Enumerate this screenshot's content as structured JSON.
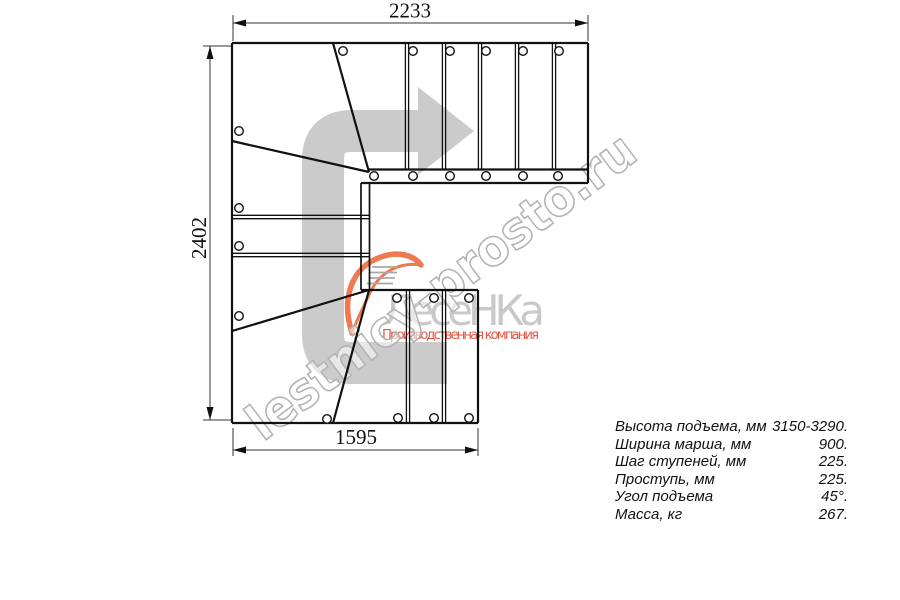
{
  "drawing": {
    "dimensions": {
      "top": "2233",
      "left": "2402",
      "bottom": "1595"
    },
    "watermark": {
      "text": "lestnicy-prosto.ru"
    },
    "brand": {
      "name": "ЛесеНКа",
      "tagline": "Производственная компания"
    },
    "colors": {
      "line": "#111111",
      "direction_arrow": "#cbcbcb",
      "watermark_stroke": "#b3b3b3",
      "brand_gray": "#c9c9c9",
      "brand_red": "#e25a47",
      "logo_orange": "#ef7a50"
    }
  },
  "specs": {
    "rows": [
      {
        "label": "Высота подъема, мм",
        "value": "3150-3290."
      },
      {
        "label": "Ширина марша, мм",
        "value": "900."
      },
      {
        "label": "Шаг ступеней, мм",
        "value": "225."
      },
      {
        "label": "Проступь, мм",
        "value": "225."
      },
      {
        "label": "Угол подъема",
        "value": "45°."
      },
      {
        "label": "Масса, кг",
        "value": "267."
      }
    ]
  }
}
